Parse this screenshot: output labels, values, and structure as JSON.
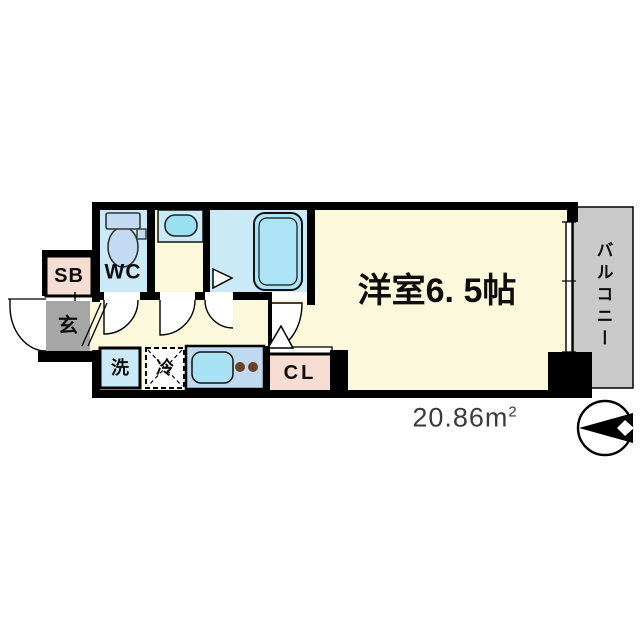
{
  "floorplan": {
    "labels": {
      "main_room": "洋室6. 5帖",
      "balcony": "バルコニー",
      "wc": "WC",
      "shoe_box": "SB",
      "entrance": "玄",
      "washer": "洗",
      "refrigerator": "冷",
      "closet": "CL"
    },
    "area": {
      "main": "20.86m",
      "sup": "2"
    },
    "colors": {
      "floor_cream": "#FBF8DC",
      "wet_area_blue": "#C9EAF6",
      "fixture_blue": "#C3DAF3",
      "basin_blue": "#9ADFF2",
      "tub_blue": "#ACE4F6",
      "sink_blue": "#A9E2F4",
      "kitchen_blue": "#BFD9EF",
      "closet_pink": "#F6DDD2",
      "entrance_gray": "#A6A6A6",
      "balcony_gray": "#C9C9C9",
      "wall_black": "#000000",
      "burner_brown": "#6B4226",
      "area_text": "#3A3A3A"
    }
  }
}
